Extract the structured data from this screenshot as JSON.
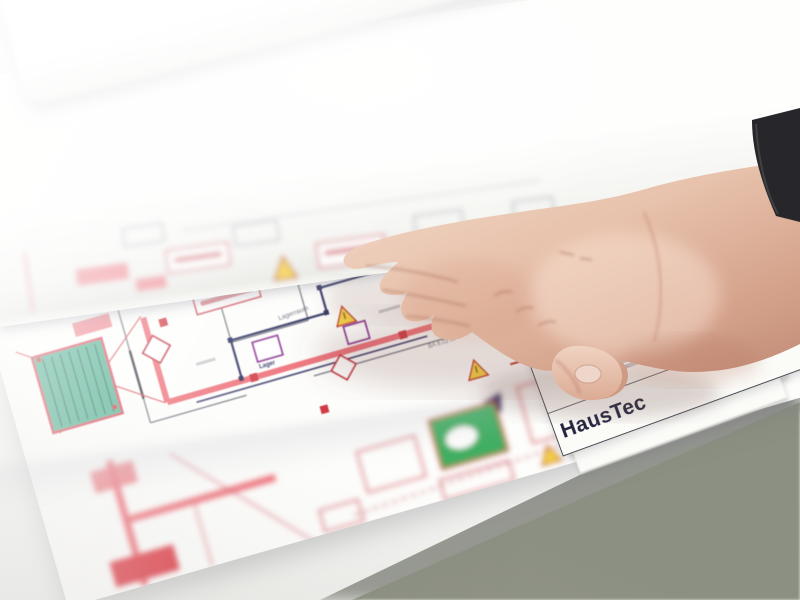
{
  "scene": {
    "table_color": "#f5f6f4",
    "floor_color": "#858a7c",
    "wall_color": "#90948a",
    "sleeve_color": "#27272b",
    "skin_color": "#e3bba6"
  },
  "titleblock": {
    "brand": "HausTec",
    "legend": {
      "eq": "=",
      "label": "Dargestellter Bereich",
      "symbol_color": "#c8232c",
      "green_symbol_color": "#2f8f3e"
    },
    "rows": [
      {
        "value": "März 2023"
      },
      {
        "value": "2x15x15"
      },
      {
        "value": "Plan B10"
      }
    ],
    "firm": "Ingenieurbüro"
  },
  "plan": {
    "labels": {
      "room1": "Lagerraum",
      "room2": "Lager",
      "dimension": "BA 8.03 m"
    },
    "colors": {
      "wall_pink": "#ee7079",
      "room_teal": "#57b194",
      "warning_yellow": "#f5d042",
      "line_navy": "#2c2e5f",
      "accent_red": "#d23a45",
      "accent_purple": "#93389b",
      "line_green": "#5a7a1f"
    },
    "icons": {
      "warning_triangle": "⚠",
      "legend_swatch": "■"
    }
  }
}
